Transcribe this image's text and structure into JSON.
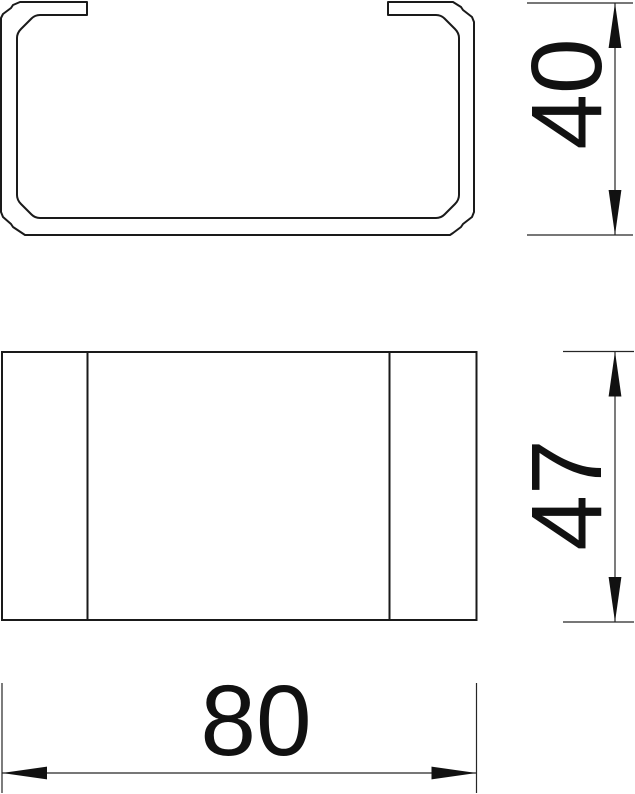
{
  "drawing": {
    "background_color": "#ffffff",
    "line_color": "#1a1a1a",
    "dimension_line_color": "#262626",
    "views": [
      {
        "id": "profile-view",
        "description": "C-channel profile outline with open slot at top, chamfered corners, double-line wall"
      },
      {
        "id": "front-view",
        "description": "rectangular front elevation divided by two vertical lines"
      }
    ],
    "dimensions": [
      {
        "value": "40",
        "orientation": "vertical",
        "view": "profile-view"
      },
      {
        "value": "47",
        "orientation": "vertical",
        "view": "front-view"
      },
      {
        "value": "80",
        "orientation": "horizontal",
        "view": "front-view"
      }
    ]
  }
}
